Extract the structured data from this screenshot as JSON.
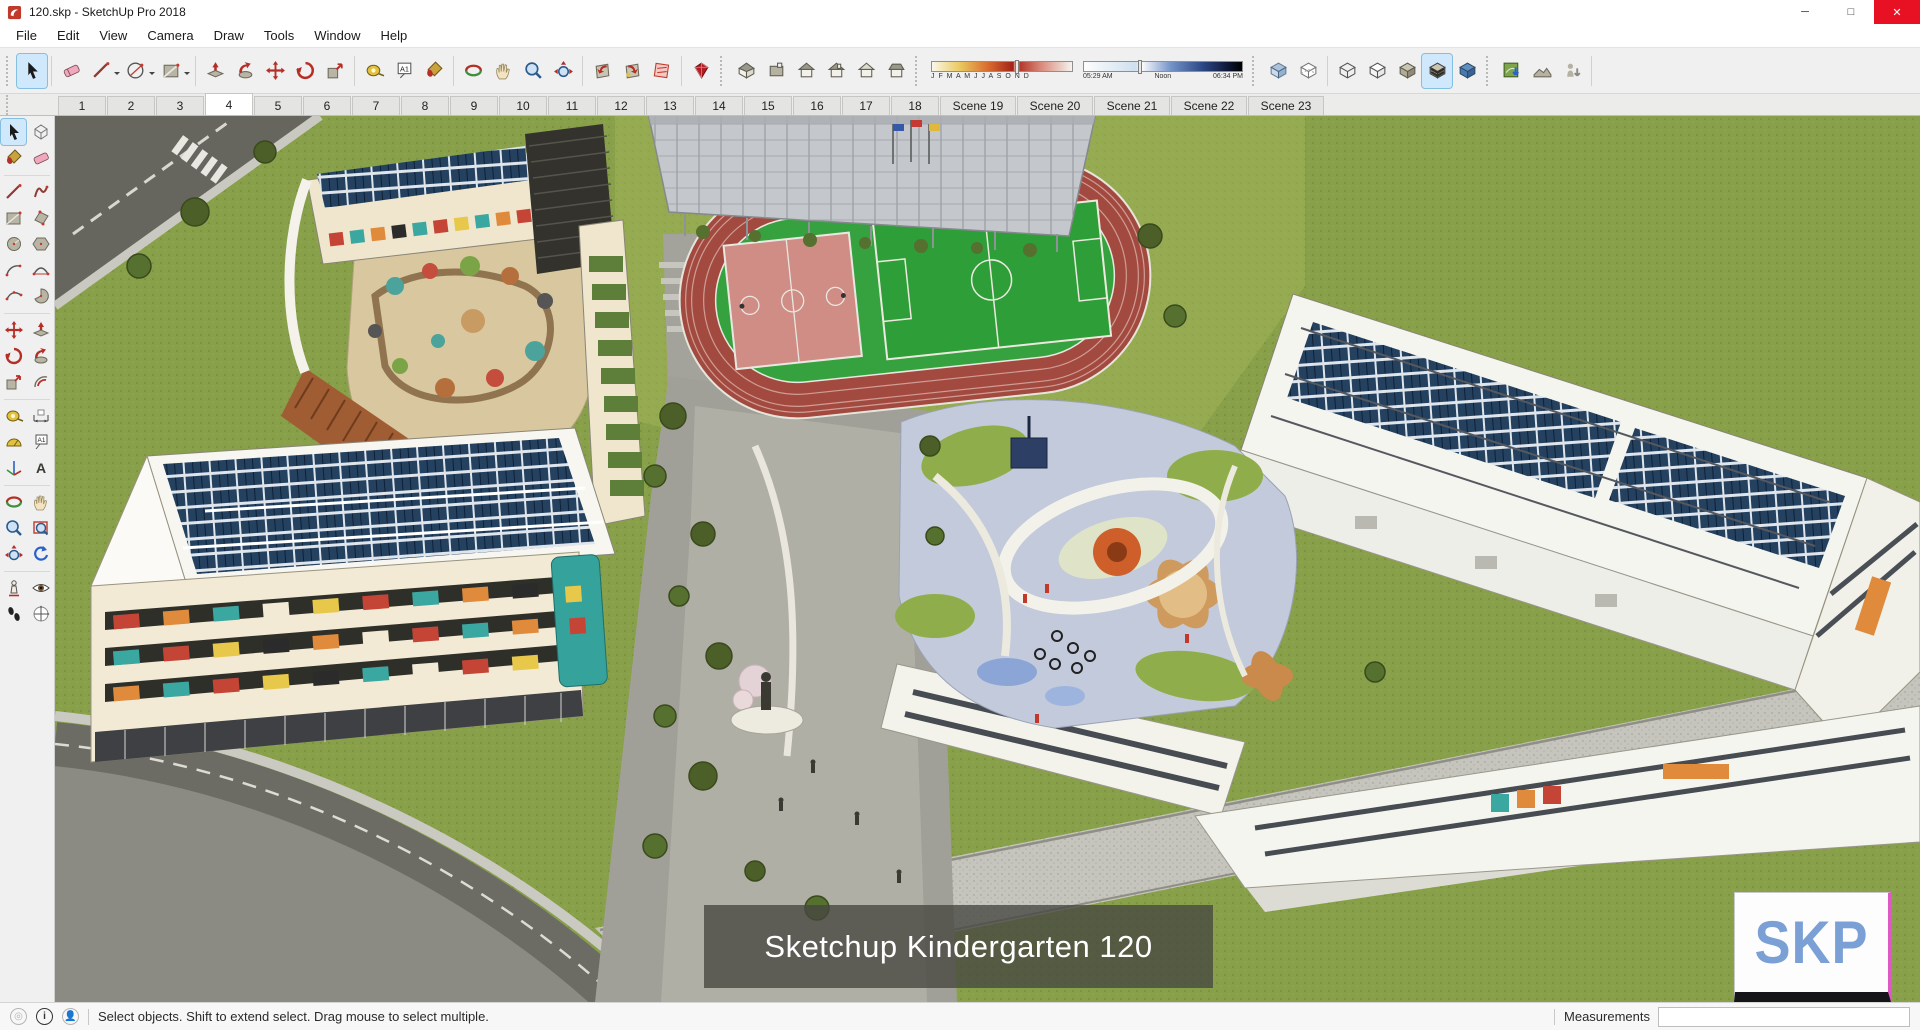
{
  "window": {
    "title": "120.skp - SketchUp Pro 2018"
  },
  "menu": {
    "items": [
      "File",
      "Edit",
      "View",
      "Camera",
      "Draw",
      "Tools",
      "Window",
      "Help"
    ]
  },
  "toolbar": {
    "shadow": {
      "months": "J F M A M J J A S O N D",
      "time_start": "05:29 AM",
      "time_mid": "Noon",
      "time_end": "06:34 PM"
    },
    "icons": [
      "select",
      "eraser",
      "line",
      "arcs",
      "shapes",
      "push-pull",
      "follow-me",
      "move",
      "rotate",
      "scale",
      "tape-measure",
      "text",
      "paint-bucket",
      "orbit",
      "pan",
      "zoom",
      "zoom-extents",
      "previous",
      "next",
      "section-plane",
      "ruby",
      "iso-view",
      "top-view",
      "front-view",
      "right-view",
      "back-view",
      "left-view",
      "x-ray",
      "back-edges",
      "wireframe",
      "hidden-line",
      "shaded",
      "shaded-with-textures",
      "monochrome",
      "add-location",
      "toggle-terrain",
      "photo-textures"
    ],
    "active_tool": "select",
    "active_style": "shaded-with-textures"
  },
  "palette": {
    "icons": [
      "select",
      "make-component",
      "paint-bucket",
      "eraser",
      "line",
      "freehand",
      "rectangle",
      "rotated-rectangle",
      "circle",
      "polygon",
      "arc",
      "two-point-arc",
      "three-point-arc",
      "pie",
      "move",
      "push-pull",
      "rotate",
      "follow-me",
      "scale",
      "offset",
      "tape-measure",
      "dimension",
      "protractor",
      "text",
      "axes",
      "3d-text",
      "orbit",
      "pan",
      "zoom",
      "zoom-window",
      "zoom-extents",
      "previous-view",
      "position-camera",
      "look-around",
      "walk",
      "section-plane"
    ],
    "active_tool": "select"
  },
  "scenes": {
    "tabs": [
      "1",
      "2",
      "3",
      "4",
      "5",
      "6",
      "7",
      "8",
      "9",
      "10",
      "11",
      "12",
      "13",
      "14",
      "15",
      "16",
      "17",
      "18",
      "Scene 19",
      "Scene 20",
      "Scene 21",
      "Scene 22",
      "Scene 23"
    ],
    "active": "4"
  },
  "viewport": {
    "caption": "Sketchup Kindergarten 120",
    "watermark": "SKP"
  },
  "status": {
    "message": "Select objects. Shift to extend select. Drag mouse to select multiple.",
    "measurements_label": "Measurements",
    "measurements_value": ""
  },
  "colors": {
    "selection_highlight": "#cfe8fb",
    "close_button": "#e81123",
    "watermark_text": "#7aa0d6",
    "caption_bg": "rgba(70,70,64,0.78)",
    "track": "#a34a40",
    "field": "#2e9e38",
    "solar_panel": "#24415f"
  }
}
